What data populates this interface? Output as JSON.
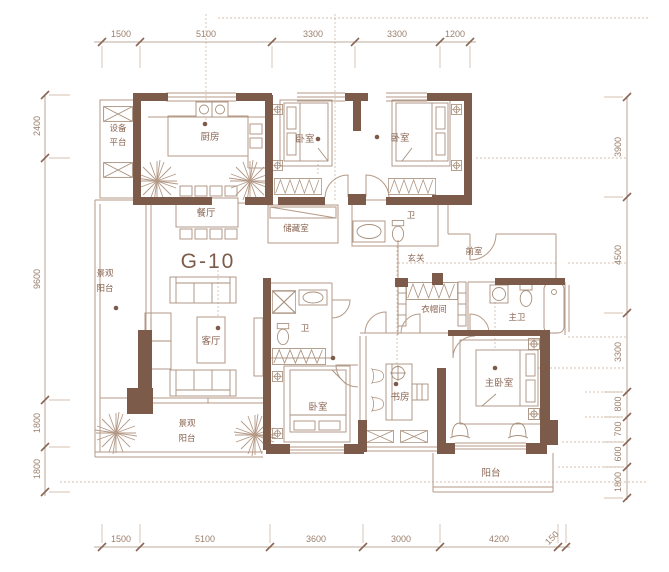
{
  "unit_label": "G-10",
  "rooms": {
    "equipment_1": "设备",
    "equipment_2": "平台",
    "kitchen": "厨房",
    "dining": "餐厅",
    "bedroom_a": "卧室",
    "bedroom_b": "卧室",
    "storage": "储藏室",
    "bath_a": "卫",
    "hall": "玄关",
    "vestibule": "前室",
    "living": "客厅",
    "balcony_left_1": "景观",
    "balcony_left_2": "阳台",
    "bath_b": "卫",
    "bedroom_c": "卧室",
    "study": "书房",
    "cloakroom": "衣帽间",
    "master_bath": "主卫",
    "master_bedroom": "主卧室",
    "balcony_bottom_1": "景观",
    "balcony_bottom_2": "阳台",
    "balcony_right": "阳台"
  },
  "dims": {
    "top": [
      "1500",
      "5100",
      "3300",
      "3300",
      "1200"
    ],
    "bottom": [
      "1500",
      "5100",
      "3600",
      "3000",
      "4200",
      "150"
    ],
    "left": [
      "2400",
      "9600",
      "1800",
      "1800"
    ],
    "right": [
      "3900",
      "4500",
      "3300",
      "800",
      "700",
      "600",
      "1800"
    ]
  },
  "colors": {
    "wall": "#7d5b4b",
    "line": "#b49a87",
    "text": "#8a6553",
    "dim_text": "#9b7f6d",
    "background": "#ffffff"
  }
}
